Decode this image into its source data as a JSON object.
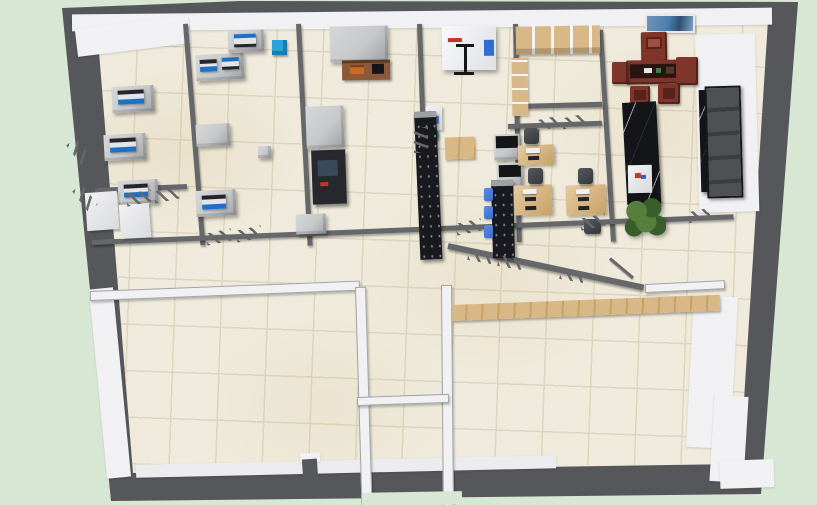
{
  "scene": {
    "type": "3d_floor_plan_render",
    "view": "top_down_perspective",
    "rooms": [
      "instrument-lab-a",
      "instrument-lab-b",
      "testing-lab",
      "chamber-room",
      "sample-storage-room",
      "reception-tea-room",
      "open-office",
      "corridor",
      "empty-room-bottom-left",
      "empty-room-bottom-right",
      "vestibule"
    ],
    "objects": [
      "lab-benches-with-analyzers",
      "fume-hood",
      "console-cabinet",
      "black-testing-machine",
      "environmental-test-chamber",
      "tripod-stand",
      "wooden-storage-shelves",
      "mahogany-tea-table-set",
      "wall-picture",
      "black-marble-reception-counter",
      "display-pedestal",
      "potted-plant",
      "entrance-door",
      "office-desks-with-monitors",
      "office-chairs",
      "blue-lab-stools",
      "teal-round-stool",
      "epoxy-black-benches",
      "wooden-floor-mat",
      "wooden-wall-counter",
      "partition-windows",
      "door-leaf"
    ]
  },
  "colors": {
    "background": "#d8e7d4",
    "outer_wall": "#56575b",
    "wall_dark": "#66676b",
    "wall_white": "#f1f1f3",
    "wall_edge": "#a3a4a8",
    "floor_tile": "#efeadb",
    "floor_grout": "#ddd5bf",
    "bench_gray": "#c7c8ca",
    "bench_shade": "#9fa0a4",
    "instrument_body": "#e3e4e6",
    "instrument_blue": "#1f6fc4",
    "instrument_dark": "#23242c",
    "epoxy_black": "#191a1f",
    "teal_stool": "#29b3a4",
    "blue_cube": "#2ba4dc",
    "mahogany": "#7f352a",
    "mahogany_dark": "#57231b",
    "wood_light": "#d8b887",
    "wood_dark": "#c7a263",
    "black_marble": "#141519",
    "marble_vein": "#9aa0a8",
    "plant_light": "#567f3b",
    "plant_dark": "#3a5e2b",
    "monitor_white": "#eef0f3",
    "keyboard_dark": "#202227",
    "chair_dark": "#34373b",
    "chair_blue": "#3a6ed0",
    "door_dark": "#3a3c3f",
    "door_frame": "#17181a",
    "chamber_white": "#f7f8fa",
    "chamber_blue": "#2d6fd0",
    "chamber_red": "#c23326",
    "picture_blue": "#4f7fae",
    "console_brown": "#8a5a3a",
    "console_orange": "#c96a2a",
    "machine_dark": "#27282d",
    "machine_screen": "#3a4a5c"
  }
}
